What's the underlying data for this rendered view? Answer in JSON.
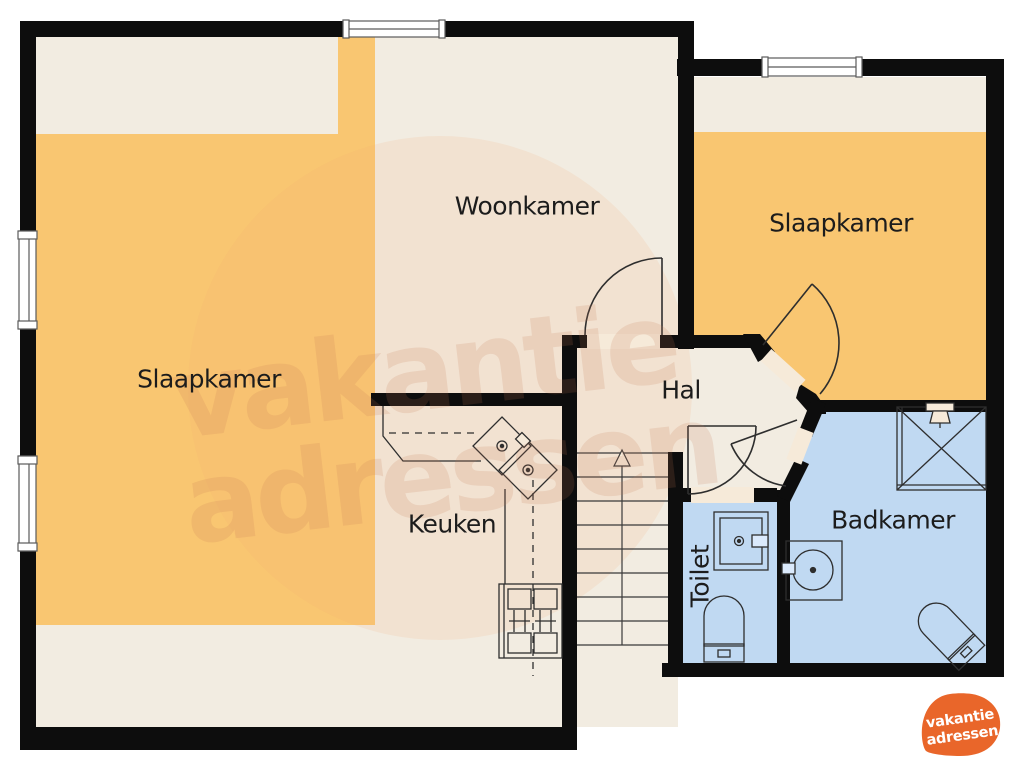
{
  "rooms": {
    "woonkamer": {
      "label": "Woonkamer"
    },
    "slaapkamer_left": {
      "label": "Slaapkamer"
    },
    "slaapkamer_right": {
      "label": "Slaapkamer"
    },
    "hal": {
      "label": "Hal"
    },
    "keuken": {
      "label": "Keuken"
    },
    "toilet": {
      "label": "Toilet"
    },
    "badkamer": {
      "label": "Badkamer"
    }
  },
  "watermark": {
    "line1": "vakantie",
    "line2": "adressen"
  },
  "logo": {
    "line1": "vakantie",
    "line2": "adressen",
    "blob_color": "#e9662a",
    "text_color": "#ffffff"
  },
  "colors": {
    "wall": "#0d0d0d",
    "floor_cream": "#f2ece1",
    "zone_orange": "#f9c671",
    "room_blue": "#c0d9f2",
    "watermark_blob": "rgba(247,168,115,0.14)",
    "fixture_outline": "#2e2e2e",
    "window_fill": "#ffffff",
    "doorway_fill": "#f6ead9"
  }
}
